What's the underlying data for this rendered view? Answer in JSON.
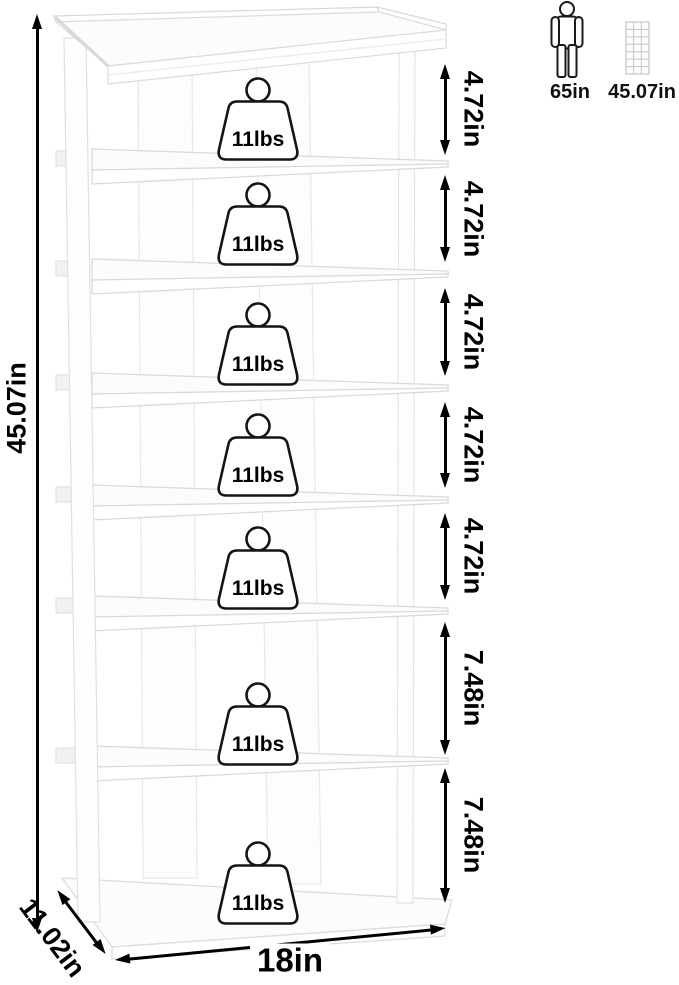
{
  "annotations": {
    "height": {
      "label": "45.07in"
    },
    "width": {
      "label": "18in"
    },
    "depth": {
      "label": "11.02in"
    },
    "shelf_gaps": [
      {
        "label": "4.72in"
      },
      {
        "label": "4.72in"
      },
      {
        "label": "4.72in"
      },
      {
        "label": "4.72in"
      },
      {
        "label": "4.72in"
      },
      {
        "label": "7.48in"
      },
      {
        "label": "7.48in"
      }
    ]
  },
  "weights": [
    {
      "label": "11lbs"
    },
    {
      "label": "11lbs"
    },
    {
      "label": "11lbs"
    },
    {
      "label": "11lbs"
    },
    {
      "label": "11lbs"
    },
    {
      "label": "11lbs"
    },
    {
      "label": "11lbs"
    }
  ],
  "reference": {
    "person": {
      "label": "65in"
    },
    "rack": {
      "label": "45.07in"
    }
  },
  "colors": {
    "annotation": "#000000",
    "rack_outline": "#d9d9d9",
    "rack_fill": "#ffffff",
    "mini_icon_gray": "#c4c4c4"
  }
}
